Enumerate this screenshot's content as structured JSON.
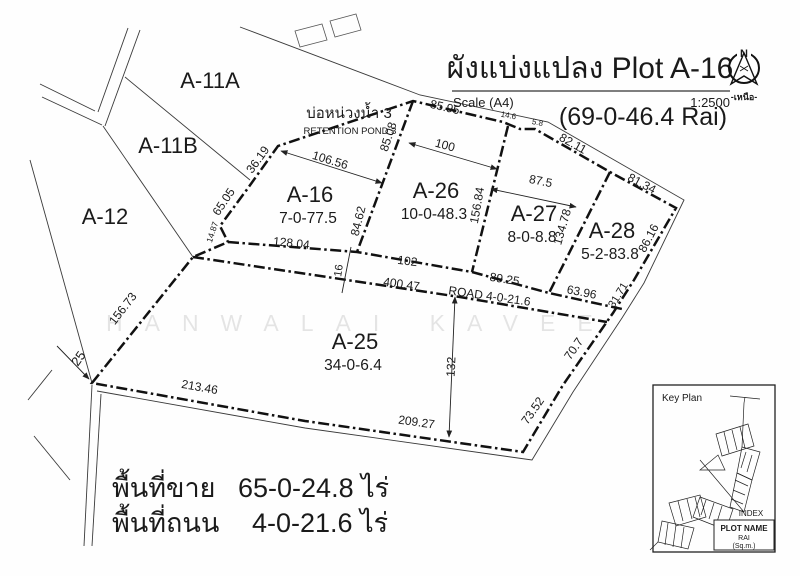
{
  "title": {
    "text": "ผังแบ่งแปลง Plot A-16",
    "scale_label": "Scale (A4)",
    "scale_value": "1:2500",
    "total_area": "(69-0-46.4 Rai)"
  },
  "north_arrow": {
    "letter": "N",
    "caption": "-เหนือ-"
  },
  "watermark": "HANWALAI KAVEE",
  "pond": {
    "thai": "บ่อหน่วงน้ำ 3",
    "english": "RETENTION POND 3"
  },
  "parcels": [
    {
      "name": "A-11A",
      "area": "",
      "x": 210,
      "y": 88
    },
    {
      "name": "A-11B",
      "area": "",
      "x": 168,
      "y": 153
    },
    {
      "name": "A-12",
      "area": "",
      "x": 105,
      "y": 224
    },
    {
      "name": "A-16",
      "area": "7-0-77.5",
      "x": 310,
      "y": 202
    },
    {
      "name": "A-26",
      "area": "10-0-48.3",
      "x": 436,
      "y": 198
    },
    {
      "name": "A-27",
      "area": "8-0-8.8",
      "x": 534,
      "y": 221
    },
    {
      "name": "A-28",
      "area": "5-2-83.8",
      "x": 612,
      "y": 238
    },
    {
      "name": "A-25",
      "area": "34-0-6.4",
      "x": 355,
      "y": 349
    }
  ],
  "dimensions": [
    {
      "t": "85.95",
      "x": 444,
      "y": 111,
      "r": 13,
      "s": 12
    },
    {
      "t": "14.6",
      "x": 508,
      "y": 118,
      "r": 10,
      "s": 8
    },
    {
      "t": "5.8",
      "x": 537,
      "y": 125,
      "r": 12,
      "s": 8
    },
    {
      "t": "82.11",
      "x": 571,
      "y": 147,
      "r": 29,
      "s": 12
    },
    {
      "t": "81.34",
      "x": 640,
      "y": 187,
      "r": 28,
      "s": 12
    },
    {
      "t": "86.16",
      "x": 652,
      "y": 240,
      "r": -62,
      "s": 12
    },
    {
      "t": "31.71",
      "x": 621,
      "y": 297,
      "r": -58,
      "s": 11
    },
    {
      "t": "70.7",
      "x": 577,
      "y": 351,
      "r": -55,
      "s": 12
    },
    {
      "t": "73.52",
      "x": 536,
      "y": 413,
      "r": -55,
      "s": 12
    },
    {
      "t": "63.96",
      "x": 581,
      "y": 296,
      "r": 11,
      "s": 12
    },
    {
      "t": "89.25",
      "x": 504,
      "y": 283,
      "r": 9,
      "s": 12
    },
    {
      "t": "102",
      "x": 407,
      "y": 265,
      "r": 7,
      "s": 12
    },
    {
      "t": "400.47",
      "x": 401,
      "y": 288,
      "r": 8,
      "s": 12
    },
    {
      "t": "ROAD  4-0-21.6",
      "x": 489,
      "y": 300,
      "r": 8,
      "s": 12
    },
    {
      "t": "128.04",
      "x": 291,
      "y": 247,
      "r": 6,
      "s": 12
    },
    {
      "t": "16",
      "x": 342,
      "y": 271,
      "r": -82,
      "s": 11
    },
    {
      "t": "84.62",
      "x": 362,
      "y": 222,
      "r": -76,
      "s": 12
    },
    {
      "t": "85.08",
      "x": 392,
      "y": 138,
      "r": -72,
      "s": 12
    },
    {
      "t": "106.56",
      "x": 329,
      "y": 164,
      "r": 17,
      "s": 12
    },
    {
      "t": "100",
      "x": 444,
      "y": 149,
      "r": 15,
      "s": 12
    },
    {
      "t": "87.5",
      "x": 540,
      "y": 185,
      "r": 11,
      "s": 12
    },
    {
      "t": "156.84",
      "x": 481,
      "y": 206,
      "r": -80,
      "s": 12
    },
    {
      "t": "134.78",
      "x": 566,
      "y": 228,
      "r": -74,
      "s": 12
    },
    {
      "t": "36.19",
      "x": 261,
      "y": 162,
      "r": -54,
      "s": 12
    },
    {
      "t": "65.05",
      "x": 227,
      "y": 204,
      "r": -56,
      "s": 12
    },
    {
      "t": "14.87",
      "x": 215,
      "y": 233,
      "r": -72,
      "s": 8.5
    },
    {
      "t": "156.73",
      "x": 126,
      "y": 311,
      "r": -52,
      "s": 12
    },
    {
      "t": "25",
      "x": 82,
      "y": 361,
      "r": -55,
      "s": 13
    },
    {
      "t": "213.46",
      "x": 199,
      "y": 391,
      "r": 10,
      "s": 12
    },
    {
      "t": "209.27",
      "x": 416,
      "y": 426,
      "r": 8,
      "s": 12
    },
    {
      "t": "132",
      "x": 455,
      "y": 367,
      "r": -87,
      "s": 12
    }
  ],
  "summary": {
    "rows": [
      {
        "label": "พื้นที่ขาย",
        "value": "65-0-24.8 ไร่"
      },
      {
        "label": "พื้นที่ถนน",
        "value": "4-0-21.6 ไร่"
      }
    ]
  },
  "key_plan": {
    "title": "Key Plan",
    "index_label": "INDEX",
    "box_lines": [
      "PLOT NAME",
      "RAI",
      "(Sq.m.)"
    ]
  }
}
